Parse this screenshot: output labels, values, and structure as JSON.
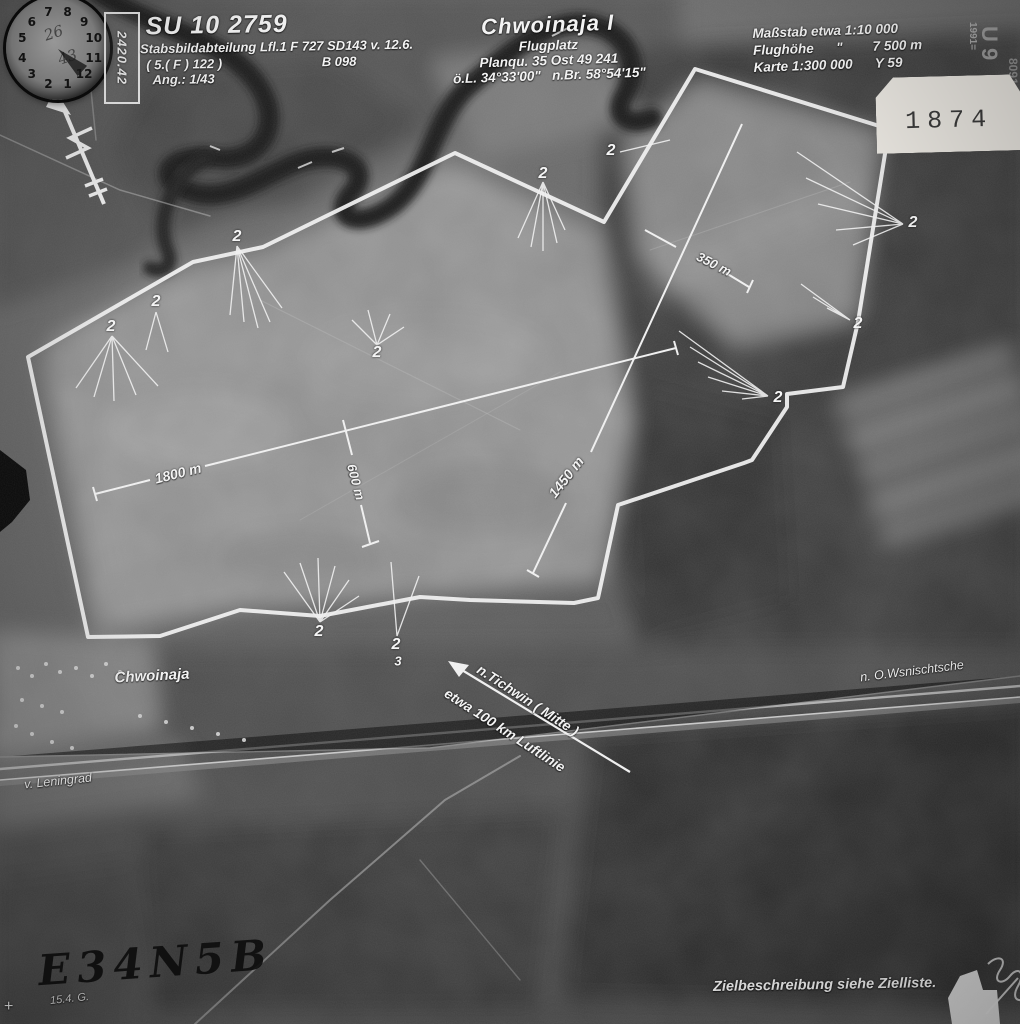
{
  "photo_edge": {
    "mission_box": "2420.42",
    "edge_top": "1991=",
    "edge_big": "U 9",
    "edge_side": "8091"
  },
  "clock": {
    "numbers": [
      "1",
      "2",
      "3",
      "4",
      "5",
      "6",
      "7",
      "8",
      "9",
      "10",
      "11",
      "12"
    ],
    "note1": "26",
    "note2": "43"
  },
  "header_left": {
    "id": "SU 10 2759",
    "unit": "Stabsbildabteilung Lfl.1 F 727 SD143 v. 12.6.",
    "unit2": "( 5.( F ) 122 )",
    "film": "B 098",
    "ang": "Ang.: 1/43"
  },
  "header_center": {
    "title": "Chwoinaja I",
    "subtitle": "Flugplatz",
    "grid": "Planqu. 35 Ost 49 241",
    "coords": "ö.L. 34°33'00\"   n.Br. 58°54'15\""
  },
  "header_right": {
    "scale": "Maßstab etwa 1:10 000",
    "altitude": "Flughöhe      \"        7 500 m",
    "map": "Karte 1:300 000      Y 59"
  },
  "stamp": {
    "number": "1874"
  },
  "measurements": {
    "m1800": "1800 m",
    "m600": "600 m",
    "m1450": "1450 m",
    "m350": "350 m"
  },
  "callouts": {
    "c1": "2",
    "c2": "2",
    "c3": "2",
    "c4": "2",
    "c5": "2",
    "c6": "2",
    "c7": "2",
    "c8": "2",
    "c9": "2",
    "c10": "2",
    "c11": "2",
    "c12": "3"
  },
  "labels": {
    "village": "Chwoinaja",
    "arrow_line1": "n.Tichwin ( Mitte )",
    "arrow_line2": "etwa 100 km Luftlinie",
    "road_right": "n. O.Wsnischtsche",
    "road_left": "v. Leningrad",
    "target_code": "E34N5B",
    "date_note": "15.4. G.",
    "plus_mark": "+",
    "footer": "Zielbeschreibung siehe Zielliste."
  }
}
